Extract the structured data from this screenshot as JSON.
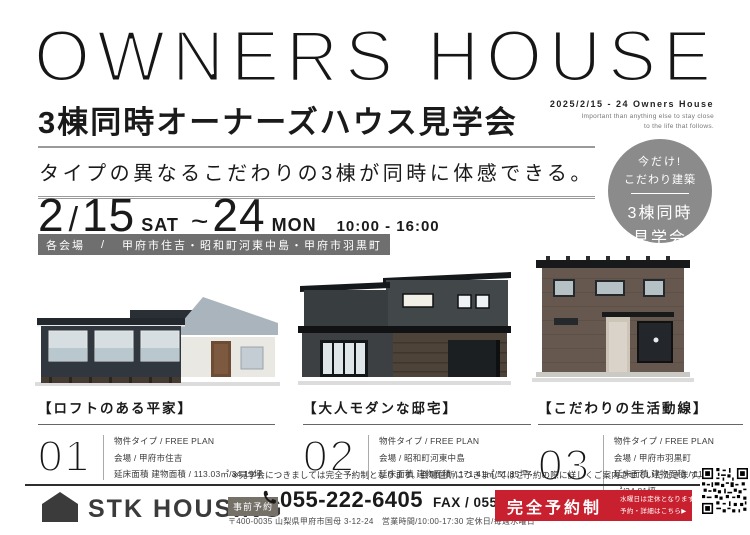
{
  "header": {
    "title": "OWNERS HOUSE",
    "subtitle": "3棟同時オーナーズハウス見学会",
    "date_small": "2025/2/15 - 24 Owners House",
    "en_line1": "Important than anything else to stay close",
    "en_line2": "to the life that follows."
  },
  "tagline": "タイプの異なるこだわりの3棟が同時に体感できる。",
  "event": {
    "month": "2",
    "slash": "/",
    "day_start": "15",
    "dow_start": "SAT",
    "tilde": "~",
    "day_end": "24",
    "dow_end": "MON",
    "time": "10:00 - 16:00"
  },
  "venue_bar": {
    "label": "各会場",
    "sep": "/",
    "locations": "甲府市住吉・昭和町河東中島・甲府市羽黒町"
  },
  "badge": {
    "line1": "今だけ!",
    "line2": "こだわり建築",
    "line3": "3棟同時",
    "line4": "見学会"
  },
  "houses": [
    {
      "number": "01",
      "name": "【ロフトのある平家】",
      "lines": [
        "物件タイプ / FREE PLAN",
        "会場 / 甲府市住吉",
        "延床面積 建物面積 / 113.03㎡/34.19坪"
      ]
    },
    {
      "number": "02",
      "name": "【大人モダンな邸宅】",
      "lines": [
        "物件タイプ / FREE PLAN",
        "会場 / 昭和町河東中島",
        "延床面積 建物面積 / 171.41㎡/51.85坪"
      ]
    },
    {
      "number": "03",
      "name": "【こだわりの生活動線】",
      "lines": [
        "物件タイプ / FREE PLAN",
        "会場 / 甲府市羽黒町",
        "延床面積 建物面積 / 115.10㎡/34.81坪"
      ]
    }
  ],
  "note": "※見学会につきましては完全予約制となります。会場住所につきましてはご予約の際に詳しくご案内させていただきます。",
  "footer": {
    "company": "STK HOUSING",
    "reserve_badge": "事前予約",
    "phone": "055-222-6405",
    "fax": "FAX / 055-222-6466",
    "address": "〒400-0035 山梨県甲府市国母 3-12-24　営業時間/10:00-17:30 定休日/毎週水曜日",
    "red_box": {
      "main": "完全予約制",
      "sub1": "水曜日は定休となります。",
      "sub2": "予約・詳細はこちら▶"
    }
  },
  "colors": {
    "accent_red": "#c8202f",
    "badge_gray": "#8b8b8b",
    "venue_bar_gray": "#6f6f6f",
    "text_dark": "#1a1a1a"
  }
}
